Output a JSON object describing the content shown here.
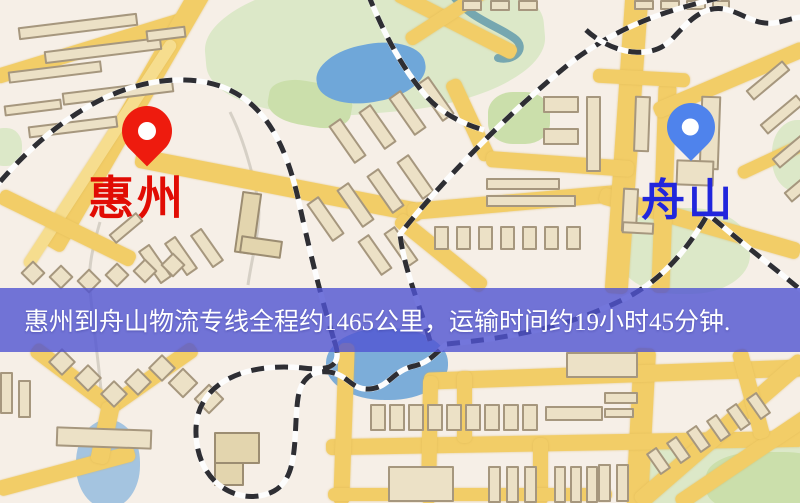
{
  "map": {
    "origin": {
      "name": "惠州",
      "pin_color": "#ee1b0e",
      "label_color": "#e10c04"
    },
    "destination": {
      "name": "舟山",
      "pin_color": "#4f83ec",
      "label_color": "#2126dc"
    },
    "banner": {
      "text": "惠州到舟山物流专线全程约1465公里，运输时间约19小时45分钟.",
      "background": "#5054d2",
      "text_color": "#ffffff"
    },
    "route": {
      "distance_km": "1465",
      "duration": "19小时45分钟"
    }
  }
}
